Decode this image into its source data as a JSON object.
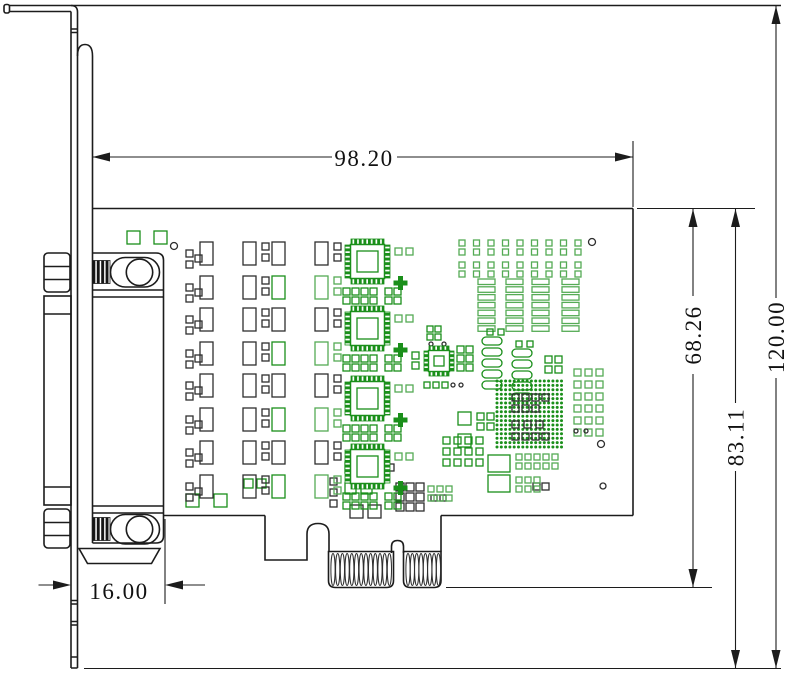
{
  "dimensions": {
    "pcb_length": "98.20",
    "overall_height": "120.00",
    "pcb_top_to_bottom_line": "83.11",
    "pcb_top_to_goldfinger_bottom": "68.26",
    "bracket_to_connector_offset": "16.00"
  },
  "colors": {
    "ink": "#1c1c1c",
    "pad_black": "#2e2e2e",
    "green_dark": "#1a8f1a",
    "green_light": "#55ab55"
  },
  "edge_connector": {
    "finger_group_a_count": 13,
    "finger_group_b_count": 8
  },
  "pcb": {
    "mag": {
      "origin_x": 186,
      "ys": [
        240,
        306,
        372,
        439
      ],
      "small": 7,
      "rw": 13,
      "rh": 23,
      "smalls": {
        "bk": [
          [
            0,
            10
          ],
          [
            0,
            21
          ],
          [
            9,
            15
          ],
          [
            76,
            3
          ],
          [
            76,
            14
          ],
          [
            148,
            3
          ],
          [
            148,
            14
          ],
          [
            0,
            44
          ],
          [
            0,
            55
          ],
          [
            9,
            49
          ],
          [
            76,
            37
          ],
          [
            76,
            48
          ]
        ],
        "g2": [
          [
            148,
            37
          ],
          [
            148,
            48
          ]
        ]
      },
      "rects": {
        "bk": [
          [
            14,
            2
          ],
          [
            57,
            2
          ],
          [
            86,
            2
          ],
          [
            129,
            2
          ],
          [
            14,
            36
          ],
          [
            57,
            36
          ]
        ],
        "g1": [
          [
            86,
            36
          ]
        ],
        "g2": [
          [
            129,
            36
          ]
        ]
      }
    },
    "qfp": {
      "s": 45,
      "instances": [
        [
          345,
          239
        ],
        [
          345,
          306
        ],
        [
          345,
          376
        ],
        [
          345,
          444
        ]
      ]
    },
    "qfn": {
      "x": 424,
      "y": 346,
      "s": 30
    },
    "groups": [
      {
        "t": "rects",
        "c": "g1",
        "items": [
          [
            127,
            231,
            13,
            13
          ],
          [
            154,
            231,
            13,
            13
          ],
          [
            186,
            494,
            13,
            13
          ],
          [
            214,
            494,
            13,
            13
          ],
          [
            244,
            479,
            9,
            9
          ],
          [
            257,
            479,
            9,
            9
          ],
          [
            345,
            462,
            11,
            11
          ],
          [
            360,
            462,
            11,
            11
          ],
          [
            345,
            483,
            11,
            11
          ],
          [
            361,
            483,
            11,
            11
          ],
          [
            458,
            412,
            13,
            13
          ],
          [
            458,
            434,
            13,
            13
          ],
          [
            488,
            455,
            22,
            17
          ],
          [
            488,
            475,
            22,
            17
          ]
        ]
      },
      {
        "t": "rects",
        "c": "bk",
        "items": [
          [
            350,
            505,
            13,
            13
          ],
          [
            368,
            505,
            13,
            13
          ],
          [
            377,
            464,
            7,
            7
          ],
          [
            387,
            464,
            7,
            7
          ],
          [
            330,
            478,
            7,
            7
          ],
          [
            330,
            489,
            7,
            7
          ],
          [
            330,
            500,
            7,
            7
          ],
          [
            533,
            483,
            7,
            7
          ],
          [
            542,
            483,
            7,
            7
          ],
          [
            431,
            495,
            6,
            6
          ],
          [
            440,
            495,
            6,
            6
          ]
        ]
      },
      {
        "t": "grid",
        "c": "bk",
        "x": 396,
        "y": 483,
        "cols": 3,
        "rows": 3,
        "s": 8,
        "dx": 10,
        "dy": 10
      },
      {
        "t": "grid",
        "c": "g2",
        "x": 428,
        "y": 486,
        "cols": 3,
        "rows": 2,
        "s": 6,
        "dx": 9,
        "dy": 9
      },
      {
        "t": "grid",
        "c": "g2",
        "x": 459,
        "y": 240,
        "cols": 9,
        "rows": 2,
        "s": 6,
        "dx": 14.5,
        "dy": 9
      },
      {
        "t": "grid",
        "c": "g2",
        "x": 459,
        "y": 262,
        "cols": 9,
        "rows": 2,
        "s": 6,
        "dx": 14.5,
        "dy": 9
      },
      {
        "t": "bars",
        "c": "g2",
        "x": 478,
        "y": 279,
        "n": 7,
        "w": 17,
        "h": 5.5,
        "dy": 7.8
      },
      {
        "t": "bars",
        "c": "g2",
        "x": 506,
        "y": 279,
        "n": 7,
        "w": 17,
        "h": 5.5,
        "dy": 7.8
      },
      {
        "t": "bars",
        "c": "g2",
        "x": 532,
        "y": 279,
        "n": 7,
        "w": 17,
        "h": 5.5,
        "dy": 7.8
      },
      {
        "t": "bars",
        "c": "g2",
        "x": 562,
        "y": 279,
        "n": 7,
        "w": 17,
        "h": 5.5,
        "dy": 7.8
      },
      {
        "t": "grid",
        "c": "g1",
        "x": 487,
        "y": 329,
        "cols": 2,
        "rows": 1,
        "s": 6,
        "dx": 11,
        "dy": 9
      },
      {
        "t": "grid",
        "c": "g1",
        "x": 516,
        "y": 341,
        "cols": 2,
        "rows": 1,
        "s": 6,
        "dx": 11,
        "dy": 9
      },
      {
        "t": "ovals",
        "c": "g1",
        "x": 482,
        "y": 337,
        "n": 5,
        "w": 20,
        "h": 8,
        "dy": 11
      },
      {
        "t": "ovals",
        "c": "g1",
        "x": 512,
        "y": 349,
        "n": 5,
        "w": 20,
        "h": 8,
        "dy": 11
      },
      {
        "t": "grid",
        "c": "g1",
        "x": 545,
        "y": 356,
        "cols": 2,
        "rows": 2,
        "s": 7,
        "dx": 10,
        "dy": 10
      },
      {
        "t": "dots",
        "x": 497,
        "y": 381,
        "cols": 16,
        "rows": 16,
        "dx": 4.3,
        "dy": 4.4,
        "r": 1.5
      },
      {
        "t": "grid",
        "c": "bk",
        "x": 512,
        "y": 394,
        "cols": 4,
        "rows": 1,
        "s": 7,
        "dx": 10,
        "dy": 10
      },
      {
        "t": "grid",
        "c": "bk",
        "x": 512,
        "y": 405,
        "cols": 3,
        "rows": 1,
        "s": 7,
        "dx": 10,
        "dy": 10
      },
      {
        "t": "grid",
        "c": "bk",
        "x": 512,
        "y": 421,
        "cols": 3,
        "rows": 1,
        "s": 7,
        "dx": 12,
        "dy": 10
      },
      {
        "t": "grid",
        "c": "bk",
        "x": 512,
        "y": 433,
        "cols": 4,
        "rows": 1,
        "s": 7,
        "dx": 10,
        "dy": 10
      },
      {
        "t": "grid",
        "c": "g2",
        "x": 574,
        "y": 369,
        "cols": 3,
        "rows": 6,
        "s": 7,
        "dx": 11,
        "dy": 12
      },
      {
        "t": "grid",
        "c": "g1",
        "x": 477,
        "y": 413,
        "cols": 2,
        "rows": 2,
        "s": 7,
        "dx": 10,
        "dy": 10
      },
      {
        "t": "grid",
        "c": "g1",
        "x": 443,
        "y": 437,
        "cols": 4,
        "rows": 3,
        "s": 7,
        "dx": 11,
        "dy": 11
      },
      {
        "t": "grid",
        "c": "g2",
        "x": 516,
        "y": 454,
        "cols": 5,
        "rows": 2,
        "s": 6,
        "dx": 9,
        "dy": 9
      },
      {
        "t": "grid",
        "c": "g2",
        "x": 516,
        "y": 477,
        "cols": 3,
        "rows": 2,
        "s": 6,
        "dx": 9,
        "dy": 9
      },
      {
        "t": "grid",
        "c": "g1",
        "x": 427,
        "y": 326,
        "cols": 2,
        "rows": 2,
        "s": 6,
        "dx": 8,
        "dy": 8
      },
      {
        "t": "grid",
        "c": "g1",
        "x": 412,
        "y": 352,
        "cols": 1,
        "rows": 2,
        "s": 7,
        "dx": 8,
        "dy": 10
      },
      {
        "t": "grid",
        "c": "g1",
        "x": 457,
        "y": 346,
        "cols": 2,
        "rows": 3,
        "s": 7,
        "dx": 9,
        "dy": 9
      },
      {
        "t": "grid",
        "c": "g1",
        "x": 424,
        "y": 382,
        "cols": 3,
        "rows": 1,
        "s": 6,
        "dx": 9,
        "dy": 9
      },
      {
        "t": "circles",
        "items": [
          [
            174,
            246,
            3.5
          ],
          [
            592,
            242,
            3.5
          ],
          [
            601,
            444,
            3.5
          ],
          [
            603,
            486,
            3
          ],
          [
            431,
            344,
            2
          ],
          [
            444,
            344,
            2
          ],
          [
            453,
            385,
            2
          ],
          [
            461,
            385,
            2
          ],
          [
            576,
            431,
            2
          ],
          [
            586,
            431,
            2
          ]
        ]
      },
      {
        "t": "coils",
        "x": 333,
        "step": 4.7,
        "n": 13,
        "cy": 569.5,
        "rx": 2.1,
        "ry": 16
      },
      {
        "t": "coils",
        "x": 408,
        "step": 4.35,
        "n": 8,
        "cy": 569.5,
        "rx": 2.1,
        "ry": 16
      }
    ]
  }
}
